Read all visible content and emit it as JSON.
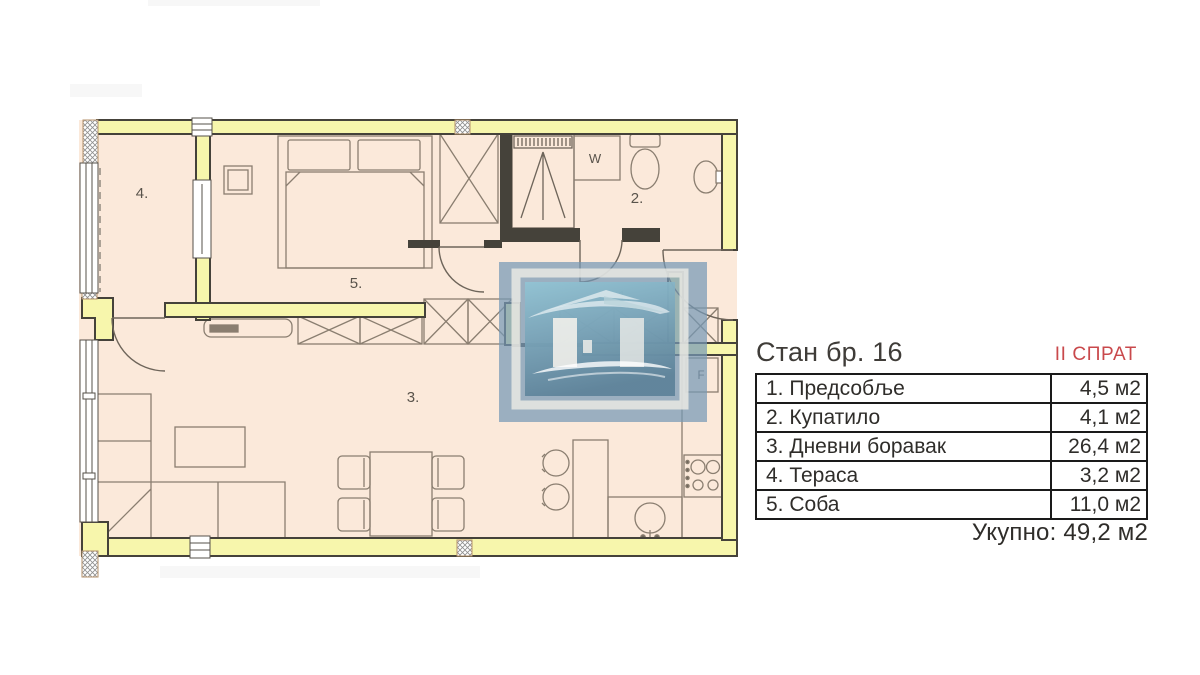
{
  "colors": {
    "wall_fill": "#f7f6ac",
    "floor_fill": "#fbe9da",
    "line_dark": "#45423a",
    "accent_red": "#c9494c",
    "logo_blue": "#7698b6"
  },
  "floor_plan": {
    "rooms": {
      "room1": "1.",
      "room2": "2.",
      "room3": "3.",
      "room4": "4.",
      "room5": "5."
    },
    "appliances": {
      "washer_label": "W",
      "fridge_label": "F"
    }
  },
  "info_panel": {
    "title": "Стан бр. 16",
    "floor_label": "II СПРАТ",
    "rows": [
      {
        "name": "1. Предсобље",
        "area": "4,5 м2"
      },
      {
        "name": "2. Купатило",
        "area": "4,1 м2"
      },
      {
        "name": "3. Дневни боравак",
        "area": "26,4 м2"
      },
      {
        "name": "4. Тераса",
        "area": "3,2 м2"
      },
      {
        "name": "5. Соба",
        "area": "11,0 м2"
      }
    ],
    "total_label": "Укупно:",
    "total_value": "49,2 м2"
  }
}
